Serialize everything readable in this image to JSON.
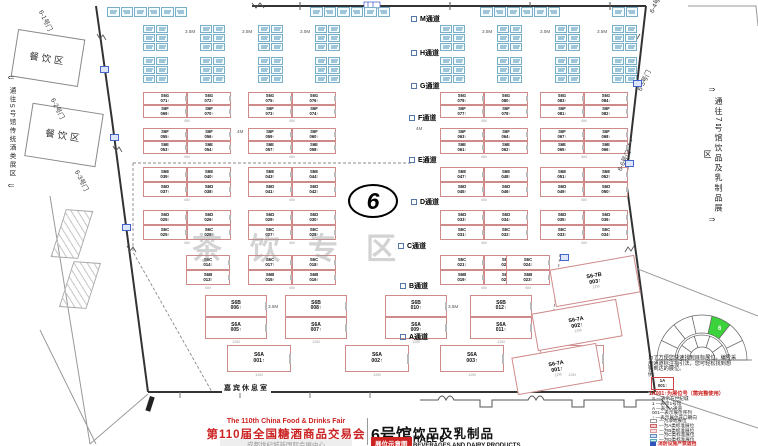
{
  "title_block": {
    "fair_title_en": "The 110th China Food & Drinks Fair",
    "fair_title_cn": "第110届全国糖酒商品交易会",
    "venue": "成都世纪城新国际会展中心",
    "hall_name_cn": "6号馆",
    "hall_category_cn": "饮品及乳制品",
    "hall_name_en": "HALL 6",
    "map_badge": "展位示意图",
    "hall_category_en": "BEVERAGES AND DAIRY PRODUCTS"
  },
  "corridor_notes": {
    "left": "通往5号馆传统酒类展区",
    "right": "通往7号馆饮品及乳制品展区"
  },
  "gates": [
    "6-1号门",
    "6-2号门",
    "6-3号门",
    "6-4号门",
    "6-5号门",
    "6-6号门"
  ],
  "areas": {
    "dining": "餐饮区",
    "guest_lounge": "嘉宾休息室",
    "tea_zone_watermark": "茶饮专区",
    "hall_number": "6"
  },
  "aisles": [
    "M通道",
    "H通道",
    "G通道",
    "F通道",
    "E通道",
    "D通道",
    "C通道",
    "B通道",
    "A通道"
  ],
  "dimensions": {
    "gap_35": "3.5M",
    "gap_4": "4M",
    "booth_6m": "6M",
    "booth_12m": "12M"
  },
  "booth_bands": [
    {
      "top": [
        "S6G 071↑",
        "S6G 072↑",
        "S6G 075↑",
        "S6G 076↑",
        "S6G 079↑",
        "S6G 080↑",
        "S6G 083↑",
        "S6G 084↑"
      ],
      "bottom": [
        "S6F 069↑",
        "S6F 070↑",
        "S6F 073↑",
        "S6F 074↑",
        "S6F 077↑",
        "S6F 078↑",
        "S6F 081↑",
        "S6F 082↑"
      ]
    },
    {
      "top": [
        "S6F 055↑",
        "S6F 056↑",
        "S6F 059↑",
        "S6F 060↑",
        "S6F 063↑",
        "S6F 064↑",
        "S6F 067↑",
        "S6F 068↑"
      ],
      "bottom": [
        "S6E 053↑",
        "S6E 054↑",
        "S6E 057↑",
        "S6E 058↑",
        "S6E 061↑",
        "S6E 062↑",
        "S6E 065↑",
        "S6E 066↑"
      ]
    },
    {
      "top": [
        "S6E 039↑",
        "S6E 040↑",
        "S6E 043↑",
        "S6E 044↑",
        "S6E 047↑",
        "S6E 048↑",
        "S6E 051↑",
        "S6E 052↑"
      ],
      "bottom": [
        "S6D 037↑",
        "S6D 038↑",
        "S6D 041↑",
        "S6D 042↑",
        "S6D 045↑",
        "S6D 046↑",
        "S6D 049↑",
        "S6D 050↑"
      ]
    },
    {
      "top": [
        "S6D 025↑",
        "S6D 026↑",
        "S6D 029↑",
        "S6D 030↑",
        "S6D 033↑",
        "S6D 034↑",
        "S6D 035↑",
        "S6D 036↑"
      ],
      "bottom": [
        "S6C 025↑",
        "S6C 026↑",
        "S6C 027↑",
        "S6C 028↑",
        "S6C 031↑",
        "S6C 032↑",
        "S6C 033↑",
        "S6C 034↑"
      ]
    },
    {
      "top": [
        "S6C 014↑",
        "S6C 017↑",
        "S6C 018↑",
        "S6C 021↑",
        "S6C 022↑",
        "S6C 024↑"
      ],
      "bottom": [
        "S6B 013↑",
        "S6B 015↑",
        "S6B 016↑",
        "S6B 019↑",
        "S6B 020↑",
        "S6B 023↑"
      ]
    },
    {
      "top": [
        "S6B 006↑",
        "S6B 008↑",
        "S6B 010↑",
        "S6B 012↑"
      ],
      "bottom": [
        "S6A 005↑",
        "S6A 007↑",
        "S6A 009↑",
        "S6A 011↑"
      ]
    },
    {
      "row": [
        "S6A 001↑",
        "S6A 002↑",
        "S6A 003↑",
        "S6A 004↑"
      ]
    }
  ],
  "corner_booths": [
    "S6-7B 003↑",
    "S6-7A 002↑",
    "S6-7A 001↑"
  ],
  "legend": {
    "intro_lines": [
      "为了方便您快速找到目标展位，编号采",
      "用通道标注指引法，您可轻松找到想",
      "要到达的展位。",
      "例:"
    ],
    "example_top": "1A",
    "example_bottom": "001↑",
    "example_note": "1A001↑为展位号（需完整使用）",
    "code_lines": [
      "S —表示在世纪城",
      "1 —表示1号馆",
      "A —表示A通道",
      "001—表示展位序列",
      "↑ —表示展位开口朝向"
    ],
    "booth_types": [
      {
        "label": "—为净地展位",
        "fill": "#ffffff",
        "border": "#999999"
      },
      {
        "label": "—为A类标准展位",
        "fill": "#f6caca",
        "border": "#cc6666"
      },
      {
        "label": "—为B类标准展位",
        "fill": "#fbe3e3",
        "border": "#dd9999"
      },
      {
        "label": "—为C类标准展位",
        "fill": "#cfe2f4",
        "border": "#6688bb"
      },
      {
        "label": "—为D类标准展位",
        "fill": "#d5f1f6",
        "border": "#55aabb"
      }
    ],
    "fire_note": "消防设施严禁遮挡",
    "minimap_highlight": "6"
  },
  "colors": {
    "accent_red": "#cc2222",
    "booth_red_border": "#cf8a8a",
    "booth_blue_border": "#79aec8",
    "green_highlight": "#3bd23b"
  }
}
